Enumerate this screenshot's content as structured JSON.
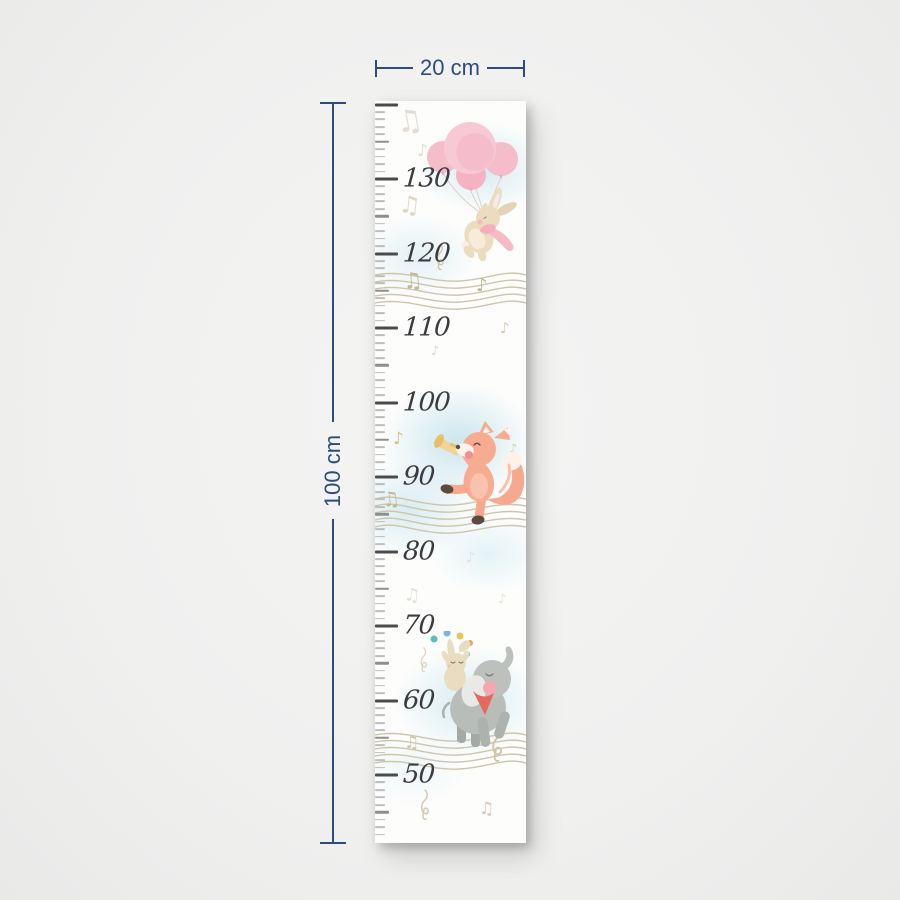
{
  "dimensions": {
    "width_label": "20 cm",
    "height_label": "100 cm",
    "line_color": "#2e4b7d"
  },
  "ruler": {
    "unit": "cm",
    "max_cm": 140,
    "min_cm": 42,
    "px_per_cm": 7.45,
    "top_offset": 3.5,
    "labels": [
      {
        "text": "130",
        "cm": 130
      },
      {
        "text": "120",
        "cm": 120
      },
      {
        "text": "110",
        "cm": 110
      },
      {
        "text": "100",
        "cm": 100
      },
      {
        "text": "90",
        "cm": 90
      },
      {
        "text": "80",
        "cm": 80
      },
      {
        "text": "70",
        "cm": 70
      },
      {
        "text": "60",
        "cm": 60
      },
      {
        "text": "50",
        "cm": 50
      }
    ],
    "colors": {
      "major": "#4b4b4e",
      "half": "#8e8e90",
      "minor": "#bdbdbf",
      "label": "#3c3c40"
    }
  },
  "icons": {
    "note_single": "♪",
    "note_double": "♫"
  },
  "illustrations": [
    {
      "id": "bunny-with-balloons"
    },
    {
      "id": "fox-with-trumpet"
    },
    {
      "id": "elephant-with-juggling-bunny"
    }
  ],
  "palette": {
    "balloon_pink": "#f8c9d5",
    "bunny_beige": "#ebdcc0",
    "scarf_pink": "#f6b9c6",
    "fox_coral": "#f7ab91",
    "trumpet_gold": "#eecb7c",
    "elephant_gray": "#b9bdba",
    "scarf_red": "#e4685c",
    "staff_tan": "#cfc5ac",
    "watercolor_blue": "#cfe6ee",
    "background": "#f0f0ef",
    "chart_background": "#fdfdfc"
  }
}
